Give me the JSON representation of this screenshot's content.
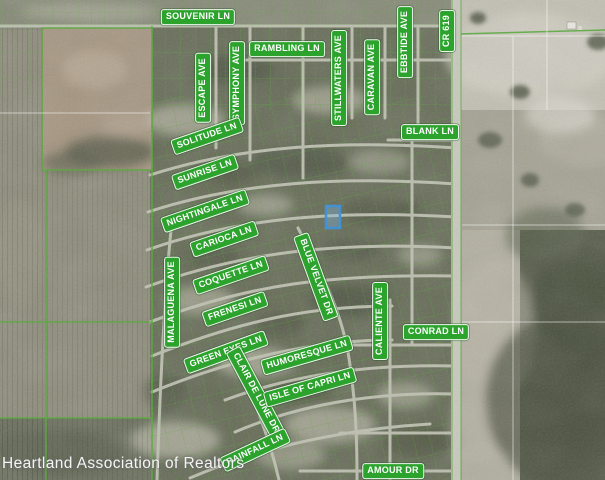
{
  "map": {
    "description": "Aerial parcel map with street name overlays and one lot highlighted in blue",
    "watermark": "Heartland Association of Realtors",
    "highlighted_parcel": {
      "label": "subject-property-lot",
      "outline_color": "#3a8fd8"
    },
    "colors": {
      "street_label_background": "#2ba32c",
      "street_label_border": "#ffffff",
      "street_label_text": "#ffffff",
      "parcel_line_green": "#58a83a",
      "highlight_blue": "#3a8fd8"
    },
    "street_labels": {
      "souvenir": "SOUVENIR LN",
      "rambling": "RAMBLING LN",
      "escape": "ESCAPE AVE",
      "symphony": "SYMPHONY AVE",
      "stillwaters": "STILLWATERS AVE",
      "caravan": "CARAVAN AVE",
      "ebbtide": "EBBTIDE AVE",
      "cr619": "CR 619",
      "blank": "BLANK LN",
      "solitude": "SOLITUDE LN",
      "sunrise": "SUNRISE LN",
      "nightingale": "NIGHTINGALE LN",
      "carioca": "CARIOCA LN",
      "malaguena": "MALAGUENA AVE",
      "coquette": "COQUETTE LN",
      "blue_velvet": "BLUE VELVET DR",
      "frenesi": "FRENESI LN",
      "caliente": "CALIENTE AVE",
      "conrad": "CONRAD LN",
      "green_eyes": "GREEN EYES LN",
      "humoresque": "HUMORESQUE LN",
      "clair_de_lune": "CLAIR DE LUNE DR",
      "isle_of_capri": "ISLE OF CAPRI LN",
      "rainfall": "RAINFALL LN",
      "amour": "AMOUR DR"
    }
  }
}
